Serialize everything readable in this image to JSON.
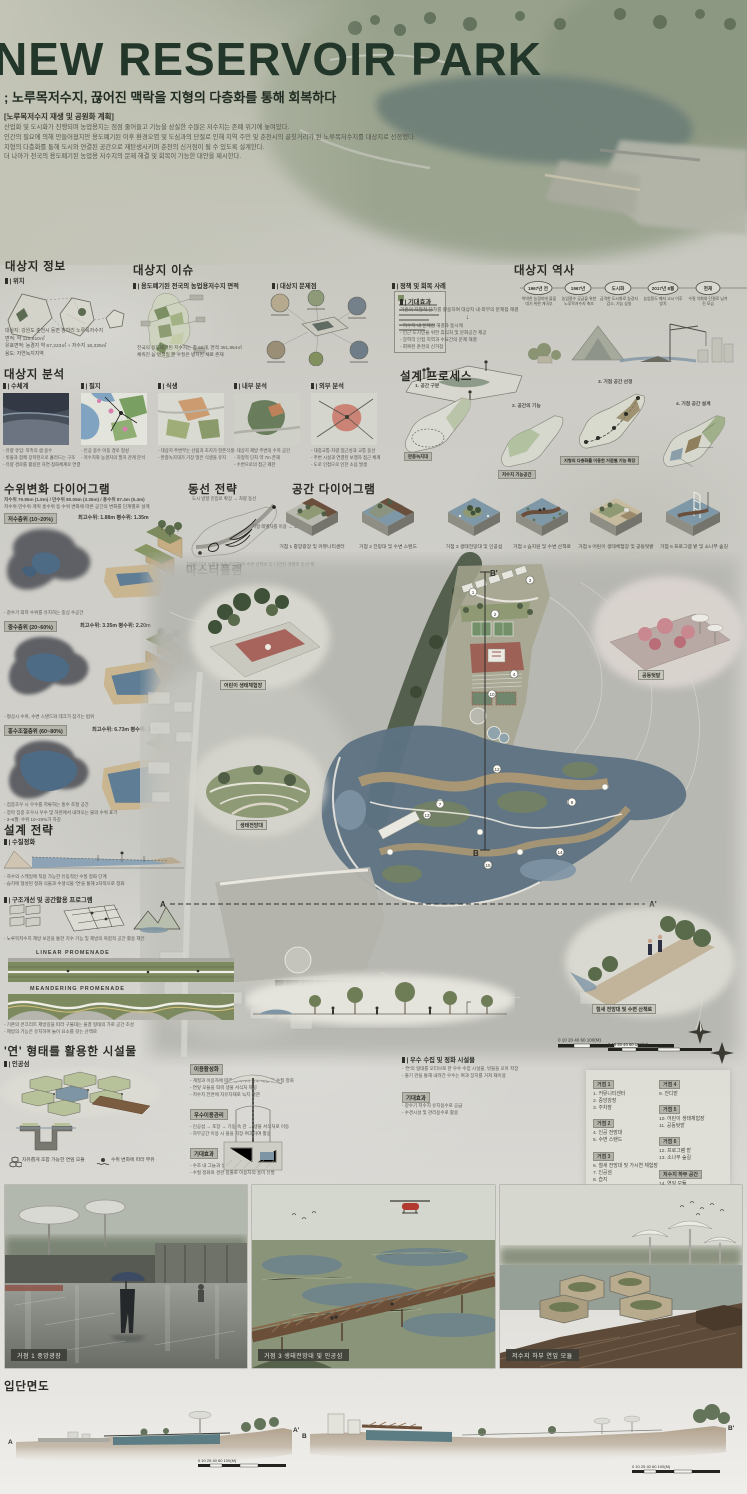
{
  "poster": {
    "title": "NEW RESERVOIR PARK",
    "subtitle": "; 노루목저수지, 끊어진 맥락을 지형의 다층화를 통해 회복하다",
    "type_label": "[노루목저수지 재생 및 공원화 계획]",
    "intro": [
      "산업화 및 도시화가 진행되며 농업용지는 점점 줄어들고 기능을 상실한 수많은 저수지는 존폐 위기에 놓여있다.",
      "인간의 필요에 의해 만들어졌지만 용도폐기된 이후 환경오염 및 도심과의 단절로 인해 지역 주민 및 춘천시의 골칫거리가 된 노루목저수지를 대상지로 선정했다.",
      "지형의 다층화를 통해 도시와 연결된 공간으로 재탄생시키며 춘천의 신거점이 될 수 있도록 설계한다.",
      "더 나아가 전국의 용도폐기된 농업용 저수지의 문제 해결 및 회복이 가능한 대안을 제시한다."
    ]
  },
  "site_info": {
    "heading": "대상지 정보",
    "loc_label": "| 위치",
    "details": [
      "대상지: 강원도 춘천시 동면 장학리 노루목저수지",
      "면적: 약 115,610㎡",
      "유효면적: 농경지 약 67,223㎡ + 저수지 18,335㎡",
      "용도: 자연녹지지역"
    ]
  },
  "site_issue": {
    "heading": "대상지 이슈",
    "sub_map": "| 용도폐기된 전국의 농업용저수지 면적",
    "sub_problem": "| 대상지 문제점",
    "sub_policy": "| 정책 및 회복 사례",
    "map_notes": [
      "전국의 용도폐기된 저수지는 총 58개, 면적 361,864㎡",
      "채워진 늪 면적일 뿐 수질은 방치된 채로 존재"
    ]
  },
  "expectation": {
    "label": "| 기대효과",
    "intro": "기존의 지형적 단차를 활용하여 대상지 내·외부의 문제점 해결",
    "bullets": [
      "- 저수지 내 문제점 해결과 동시에",
      "- 인근 도시민을 위한 휴식처 및 문화공간 제공",
      "- 장학리 인접 지역과 수요간의 문제 해결",
      "- 회복된 춘천의 신거점"
    ]
  },
  "history": {
    "heading": "대상지 역사",
    "nodes": [
      {
        "label": "1967년 전",
        "caption": "척박한 농경지에 물을 대기 위한 계곡부"
      },
      {
        "label": "1967년",
        "caption": "농업용수 공급을 위한 노루목저수지 축조"
      },
      {
        "label": "도시화",
        "caption": "급격한 도시화로 농경지 감소, 기능 상실"
      },
      {
        "label": "2017년 8월",
        "caption": "농업용도 폐지 고시 이후 방치"
      },
      {
        "label": "현재",
        "caption": "수질 악화와 단절로 남겨진 모습"
      }
    ]
  },
  "analysis": {
    "heading": "대상지 분석",
    "panels": [
      {
        "label": "| 수체계",
        "bullets": [
          "- 유량 유입: 북측의 샘 용수",
          "- 빗물과 함께 장학천으로 흘러드는 구조",
          "- 유량 경로를 활용한 자연 정화체계로 연결"
        ]
      },
      {
        "label": "| 필지",
        "bullets": [
          "- 인공 용수 이동 경로 형성",
          "- 저수지와 농경지의 필지 관계 분석"
        ]
      },
      {
        "label": "| 식생",
        "bullets": [
          "- 대상지 주변부는 산림과 초지가 현존식생",
          "- 완충녹지대가 가장 많은 식생을 유지"
        ]
      },
      {
        "label": "| 내부 분석",
        "bullets": [
          "- 대상지 제방 주변의 수목 공간",
          "- 지형적 단차 약 7m 존재",
          "- 수변으로의 접근 제한"
        ]
      },
      {
        "label": "| 외부 분석",
        "bullets": [
          "- 대중교통·차량 접근성과 교통 동선",
          "- 주변 시설과 연결된 보행자 접근 체계",
          "- 도로 인접으로 인한 소음 발생"
        ]
      }
    ]
  },
  "process": {
    "heading": "설계 프로세스",
    "steps": [
      "1. 공간 구분",
      "2. 공간의 기능",
      "3. 거점 공간 선정",
      "4. 거점 공간 설계"
    ],
    "badges": [
      "완충녹지대",
      "저수지 기능공간",
      "지형의 다층화를 이용한 거점별 기능 확장"
    ]
  },
  "water_level": {
    "heading": "수위변화 다이어그램",
    "summary": "저수위 79.85m (1.8m) / 만수위 80.05m (3.35m) / 홍수위 87.4m (5.4m)",
    "summary2": "저수위·만수위·계획 홍수위 등 수위 변화에 따른 공간의 변화를 단계별로 설계",
    "blocks": [
      {
        "badge": "저수층위 (10~20%)",
        "values": "최고수위: 1.88m    평수위: 1.35m",
        "note": "- 갈수기 최저 수위를 유지하는 중심 수공간"
      },
      {
        "badge": "중수층위 (20~60%)",
        "values": "최고수위: 3.35m    평수위: 2.20m",
        "note": "- 평상시 수위, 수변 스탠드와 데크가 잠기는 범위"
      },
      {
        "badge": "홍수조절층위 (60~80%)",
        "values": "최고수위: 6.73m    평수위: 3.88m",
        "note": "- 집중호우 시 우수를 저류하는 홍수 조절 공간"
      }
    ],
    "footnotes": [
      "- 장마 집중 호우시 우수 및 하천에서 내려오는 물의 수위 표기",
      "- 3~8월: 수위 10~20%가 하강"
    ]
  },
  "circulation": {
    "heading": "동선 전략",
    "note1": "도시 방향 진입로 확장 → 차량 동선",
    "note2": "지형 레벨차를 이용 → 보행 동선",
    "caption": "차량동선과 보행동선을 분리하며 수변 산책로 등 다양한 레벨의 동선 체계를 구축"
  },
  "space_diagram": {
    "heading": "공간 다이어그램",
    "items": [
      {
        "caption": "거점 1  중앙광장 및 커뮤니티센터"
      },
      {
        "caption": "거점 2  전망대 및 수변 스탠드"
      },
      {
        "caption": "거점 3  생태전망대 및 인공섬"
      },
      {
        "caption": "거점 4  습지원 및 수변 산책로"
      },
      {
        "caption": "거점 5  어린이 생태체험장 및 공동텃밭"
      },
      {
        "caption": "거점 6  프로그램 밭 및 소나무 숲길"
      }
    ]
  },
  "masterplan": {
    "heading": "마스터플랜",
    "a": "A",
    "a2": "A'",
    "b": "B",
    "b2": "B'",
    "vignettes": [
      "어린이 생태체험장",
      "생태전망대",
      "공동텃밭",
      "철새 전망대 및 수변 산책로"
    ],
    "scale_label": "0  10  20    40    60        100(M)",
    "markers": [
      "1",
      "2",
      "3",
      "4",
      "7",
      "8",
      "10",
      "12",
      "13",
      "14",
      "15"
    ]
  },
  "legend": {
    "groups": [
      {
        "title": "거점 1",
        "items": [
          "1. 커뮤니티센터",
          "2. 중앙광장",
          "3. 주차장"
        ]
      },
      {
        "title": "거점 2",
        "items": [
          "4. 인공 전망대",
          "5. 수변 스탠드"
        ]
      },
      {
        "title": "거점 3",
        "items": [
          "6. 철새 전망대 및 가시연 체험장",
          "7. 인공섬",
          "8. 습지"
        ]
      },
      {
        "title": "거점 4",
        "items": [
          "9. 잔디밭"
        ]
      },
      {
        "title": "거점 5",
        "items": [
          "10. 어린이 생태체험장",
          "11. 공동텃밭"
        ]
      },
      {
        "title": "거점 6",
        "items": [
          "12. 프로그램 밭",
          "13. 소나무 숲길"
        ]
      },
      {
        "title": "저수지 하부 공간",
        "items": [
          "14. 연잎 모듈",
          "15. 하부 산책로"
        ]
      }
    ]
  },
  "strategy": {
    "heading": "설계 전략",
    "water_sub": "| 수질정화",
    "water_bullets": [
      "- 하수의 스케일에 적용 가능한 유동적인 수질 정화 단계",
      "- 습지에 형성된 정화 식물과 수생식물 '연'을 통해 2차적으로 정화"
    ],
    "structure_sub": "| 구조개선 및 공간활용 프로그램",
    "structure_bullets": [
      "- 노루목저수지 제방 보강을 통한 치수 기능 및 제방의 복합적 공간 활용 제안"
    ],
    "promenade1": "LINEAR PROMENADE",
    "promenade2": "MEANDERING PROMENADE",
    "promenade_bullets": [
      "- 기존의 콘크리트 제방길을 따라 구불대는 물결 형태의 가로 공간 조성",
      "- 제방의 기능은 유지하며 놀이 요소를 갖는 산책로"
    ]
  },
  "lotus": {
    "heading": "'연' 형태를 활용한 시설물",
    "island_sub": "| 인공섬",
    "icon1": "자유롭게 조합 가능한 연잎 모듈",
    "icon2": "수위 변화에 따라 부유",
    "groups": [
      {
        "badge": "이용활성화",
        "bullets": [
          "- 계절과 이용자에 따라 움직이며 산소 배출 및 수질 정화",
          "- 연잎 모듈을 띄워 생물 서식처 제공",
          "- 저수지 전면에 자유자재로 녹지 경관"
        ]
      },
      {
        "badge": "우수이용관리",
        "bullets": [
          "- 인공섬 → 포장 → 기둥 속 관 → 생물 서식처로 이동",
          "- 하부공간 이용 시 물을 저장·여과하여 활용"
        ]
      },
      {
        "badge": "기대효과",
        "bullets": [
          "- 수조 내 그늘과 생물들의 휴식처 및 산란처 제공",
          "- 수질 정화와 경관 창출로 이용자의 흥미 유발"
        ]
      }
    ],
    "material": "재료: 목재",
    "rain_sub": "| 우수 수집 및 정화 시설물",
    "rain_bullets": [
      "- '연'의 형태를 모티브로 한 우수 수집 시설물, 빗물을 모아 저장",
      "- 줄기 관을 통해 내려간 우수는 여과 장치를 거쳐 재이용"
    ],
    "rain_effect_badge": "기대효과",
    "rain_effects": [
      "- 갈수기 저수지 유지용수로 공급",
      "- 수경시설 및 관리용수로 활용"
    ]
  },
  "renders": {
    "items": [
      {
        "caption": "거점 1  중앙광장"
      },
      {
        "caption": "거점 3  생태전망대 및 인공섬"
      },
      {
        "caption": "저수지 하부 연잎 모듈"
      }
    ]
  },
  "sections": {
    "heading": "입단면도",
    "a": "A",
    "a2": "A'",
    "b": "B",
    "b2": "B'",
    "scale": "0  10  25  40  60      100(M)"
  }
}
